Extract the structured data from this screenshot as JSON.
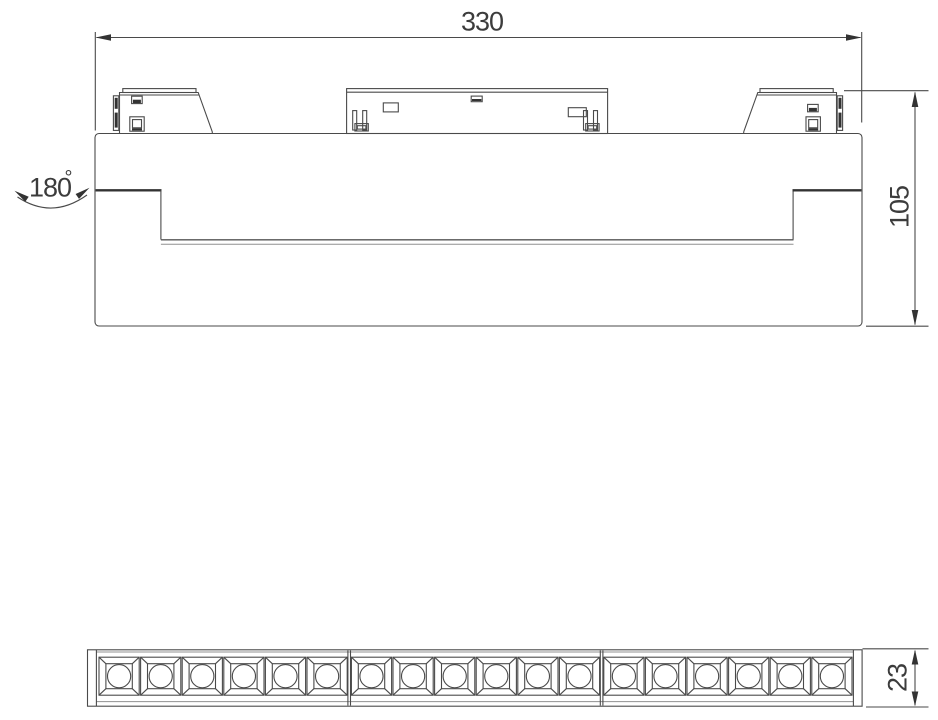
{
  "drawing": {
    "colors": {
      "background": "#ffffff",
      "line": "#4a4a4a",
      "dark": "#333333",
      "text": "#3c3c3c"
    },
    "labels": {
      "width": "330",
      "height": "105",
      "strip_height": "23",
      "rotation_angle": "180",
      "degree_symbol": "°"
    },
    "led_array": {
      "modules": 3,
      "leds_per_module": 6,
      "total_leds": 18,
      "start_x": 99,
      "module_pitch": 252.4,
      "cell_pitch": 41.6,
      "cell_width": 40.2,
      "cell_top": 657.2,
      "cell_height": 38,
      "inner_inset_x": 6.9,
      "inner_inset_y": 6.5,
      "circle_radius": 11.6,
      "strip_top": 650.5,
      "strip_bottom": 705.5
    }
  }
}
